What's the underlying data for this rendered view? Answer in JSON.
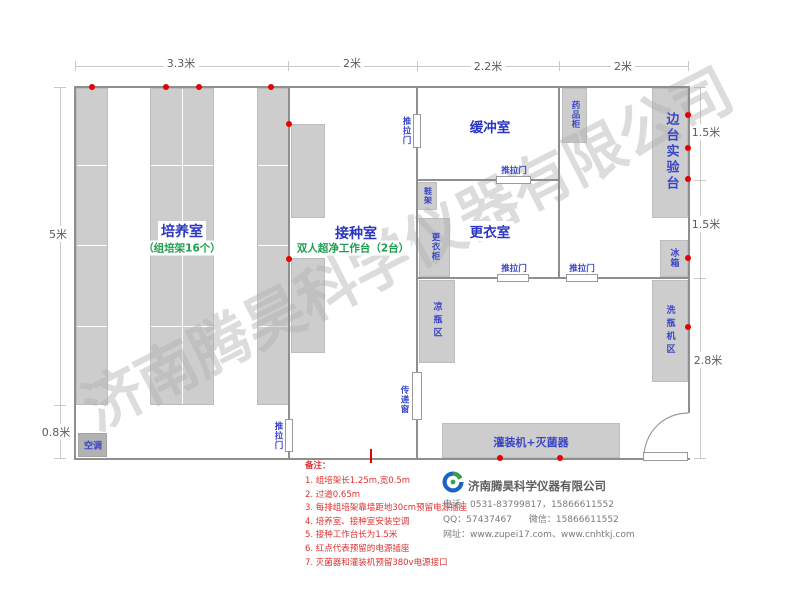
{
  "watermark": "济南腾昊科学仪器有限公司",
  "dimensions": {
    "top": [
      "3.3米",
      "2米",
      "2.2米",
      "2米"
    ],
    "left": [
      "5米",
      "0.8米"
    ],
    "right": [
      "1.5米",
      "1.5米",
      "2.8米"
    ]
  },
  "rooms": {
    "cultivation": {
      "name": "培养室",
      "sub": "（组培架16个）"
    },
    "inoculation": {
      "name": "接种室",
      "sub": "双人超净工作台（2台）"
    },
    "buffer": {
      "name": "缓冲室"
    },
    "changing": {
      "name": "更衣室"
    },
    "side_bench": {
      "name": "边台实验台"
    }
  },
  "fixtures": {
    "sliding_door": "推拉门",
    "transfer_window": "传递窗",
    "medicine_cabinet": "药品柜",
    "fridge": "冰箱",
    "shoe_rack": "鞋架",
    "wardrobe": "更衣柜",
    "bottle_cooling_area": "凉瓶区",
    "bottle_washer_area": "洗瓶机区",
    "filling_machine": "灌装机+灭菌器",
    "air_conditioner": "空调"
  },
  "notes": {
    "title": "备注：",
    "items": [
      "1. 组培架长1.25m,宽0.5m",
      "2. 过道0.65m",
      "3. 每排组培架靠墙距地30cm预留电源插座",
      "4. 培养室、接种室安装空调",
      "5. 接种工作台长为1.5米",
      "6. 红点代表预留的电源插座",
      "7. 灭菌器和灌装机预留380v电源接口"
    ]
  },
  "company": {
    "name": "济南腾昊科学仪器有限公司",
    "phone": "电话：0531-83799817，15866611552",
    "qq": "QQ：57437467",
    "wechat": "微信：15866611552",
    "website": "网址：www.zupei17.com、www.cnhtkj.com"
  },
  "colors": {
    "room_label_blue": "#2a35c2",
    "sub_label_green": "#1e9e50",
    "note_red": "#e03030",
    "outlet_dot_red": "#e60000",
    "furniture_gray": "#cdcdcd",
    "wall_gray": "#8f8f8f",
    "watermark_gray": "#b2b2b2"
  }
}
